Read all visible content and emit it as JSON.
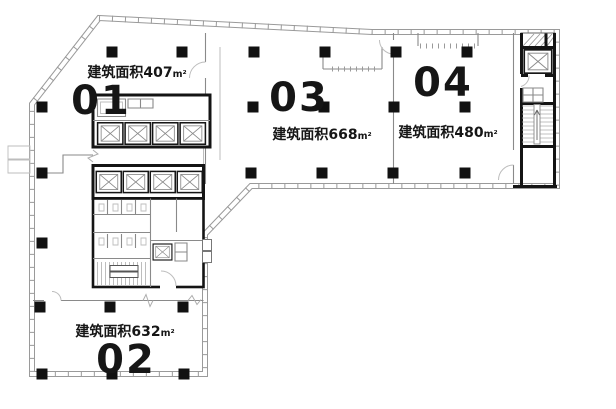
{
  "drawing": {
    "kind": "floor-plan",
    "units": [
      {
        "number": "01",
        "area_prefix": "建筑面积",
        "area_value": "407",
        "area_unit": "m²"
      },
      {
        "number": "02",
        "area_prefix": "建筑面积",
        "area_value": "632",
        "area_unit": "m²"
      },
      {
        "number": "03",
        "area_prefix": "建筑面积",
        "area_value": "668",
        "area_unit": "m²"
      },
      {
        "number": "04",
        "area_prefix": "建筑面积",
        "area_value": "480",
        "area_unit": "m²"
      }
    ],
    "colors": {
      "wall": "#141414",
      "partition": "#8a8a8a",
      "glazing": "#9a9a9a",
      "column": "#111111",
      "background": "#ffffff",
      "text": "#161616"
    }
  }
}
